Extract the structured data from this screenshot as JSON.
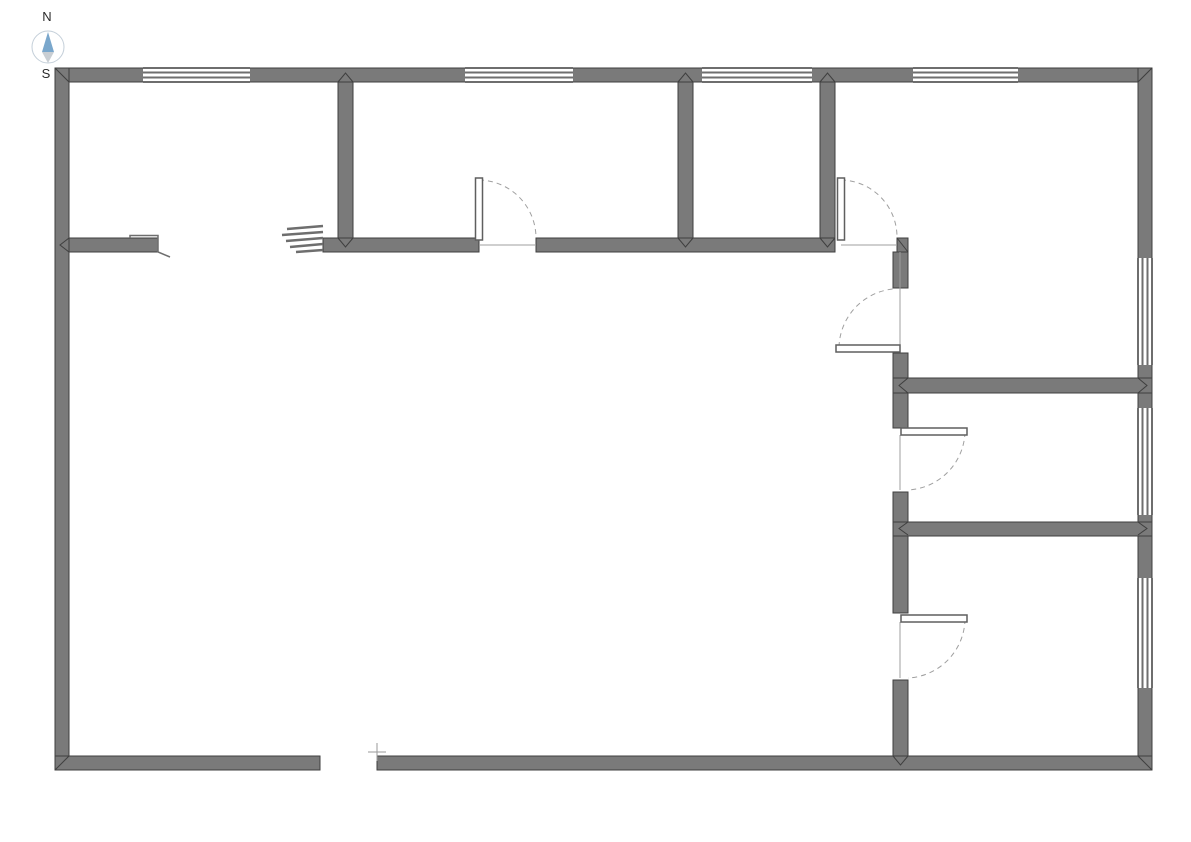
{
  "canvas": {
    "width": 1191,
    "height": 842,
    "background": "#ffffff"
  },
  "style": {
    "wall_fill": "#7a7a7a",
    "wall_stroke": "#3f3f3f",
    "window_line_color": "#6e6e6e",
    "door_line_color": "#9f9f9f"
  },
  "compass": {
    "north_label": "N",
    "south_label": "S",
    "cx": 48,
    "cy": 47,
    "radius": 16,
    "north_needle_color": "#7aa7cc",
    "south_needle_color": "#c9ced3",
    "north_points": "48,32 42,52 54,52",
    "south_points": "42,52 54,52 48,63",
    "north_label_x": 47,
    "north_label_y": 21,
    "south_label_x": 46,
    "south_label_y": 78
  },
  "floor_plan": {
    "walls": [
      {
        "name": "exterior-wall-top",
        "x": 55,
        "y": 68,
        "w": 1097,
        "h": 14
      },
      {
        "name": "exterior-wall-left",
        "x": 55,
        "y": 68,
        "w": 14,
        "h": 702
      },
      {
        "name": "exterior-wall-right",
        "x": 1138,
        "y": 68,
        "w": 14,
        "h": 702
      },
      {
        "name": "exterior-wall-bottom-west",
        "x": 55,
        "y": 756,
        "w": 265,
        "h": 14
      },
      {
        "name": "exterior-wall-bottom-east",
        "x": 377,
        "y": 756,
        "w": 775,
        "h": 14
      },
      {
        "name": "interior-wall-a",
        "x": 338,
        "y": 82,
        "w": 15,
        "h": 156
      },
      {
        "name": "interior-wall-b",
        "x": 678,
        "y": 82,
        "w": 15,
        "h": 156
      },
      {
        "name": "interior-wall-c",
        "x": 820,
        "y": 82,
        "w": 15,
        "h": 156
      },
      {
        "name": "corridor-wall-stub",
        "x": 69,
        "y": 238,
        "w": 89,
        "h": 14
      },
      {
        "name": "corridor-wall-west",
        "x": 323,
        "y": 238,
        "w": 156,
        "h": 14
      },
      {
        "name": "corridor-wall-mid",
        "x": 536,
        "y": 238,
        "w": 299,
        "h": 14
      },
      {
        "name": "corridor-wall-east",
        "x": 897,
        "y": 238,
        "w": 11,
        "h": 14
      },
      {
        "name": "right-wing-wall-seg1",
        "x": 893,
        "y": 252,
        "w": 15,
        "h": 36
      },
      {
        "name": "right-wing-wall-seg2",
        "x": 893,
        "y": 353,
        "w": 15,
        "h": 25
      },
      {
        "name": "right-wing-wall-seg3",
        "x": 893,
        "y": 393,
        "w": 15,
        "h": 35
      },
      {
        "name": "right-wing-wall-seg4",
        "x": 893,
        "y": 492,
        "w": 15,
        "h": 30
      },
      {
        "name": "right-wing-wall-seg5",
        "x": 893,
        "y": 535,
        "w": 15,
        "h": 78
      },
      {
        "name": "right-wing-wall-seg6",
        "x": 893,
        "y": 680,
        "w": 15,
        "h": 76
      },
      {
        "name": "room-divider-north",
        "x": 893,
        "y": 378,
        "w": 259,
        "h": 15
      },
      {
        "name": "room-divider-south",
        "x": 893,
        "y": 522,
        "w": 259,
        "h": 14
      }
    ],
    "windows": [
      {
        "name": "window-top-1",
        "x": 143,
        "y": 67,
        "w": 107,
        "h": 16,
        "o": "h"
      },
      {
        "name": "window-top-2",
        "x": 465,
        "y": 67,
        "w": 108,
        "h": 16,
        "o": "h"
      },
      {
        "name": "window-top-3",
        "x": 702,
        "y": 67,
        "w": 110,
        "h": 16,
        "o": "h"
      },
      {
        "name": "window-top-4",
        "x": 913,
        "y": 67,
        "w": 105,
        "h": 16,
        "o": "h"
      },
      {
        "name": "window-right-1",
        "x": 1137,
        "y": 258,
        "w": 16,
        "h": 107,
        "o": "v"
      },
      {
        "name": "window-right-2",
        "x": 1137,
        "y": 408,
        "w": 16,
        "h": 107,
        "o": "v"
      },
      {
        "name": "window-right-3",
        "x": 1137,
        "y": 578,
        "w": 16,
        "h": 110,
        "o": "v"
      }
    ],
    "doors": [
      {
        "name": "door-1",
        "leaf": {
          "x": 475.5,
          "y": 178,
          "w": 7,
          "h": 62
        },
        "arc": "M 479 180 A 58 58 0 0 1 536 238",
        "threshold": {
          "x1": 479,
          "y1": 245,
          "x2": 536,
          "y2": 245
        }
      },
      {
        "name": "door-2",
        "leaf": {
          "x": 837.5,
          "y": 178,
          "w": 7,
          "h": 62
        },
        "arc": "M 841 180 A 57 57 0 0 1 897 237",
        "threshold": {
          "x1": 841,
          "y1": 245,
          "x2": 897,
          "y2": 245
        }
      },
      {
        "name": "door-3",
        "leaf": {
          "x": 836,
          "y": 345,
          "w": 64,
          "h": 7
        },
        "arc": "M 839 347 A 60 60 0 0 1 893 289",
        "threshold": {
          "x1": 900,
          "y1": 252,
          "x2": 900,
          "y2": 345
        }
      },
      {
        "name": "door-4",
        "leaf": {
          "x": 901,
          "y": 428,
          "w": 66,
          "h": 7
        },
        "arc": "M 965 432 A 60 60 0 0 1 908 490",
        "threshold": {
          "x1": 900,
          "y1": 435,
          "x2": 900,
          "y2": 490
        }
      },
      {
        "name": "door-5",
        "leaf": {
          "x": 901,
          "y": 615,
          "w": 66,
          "h": 7
        },
        "arc": "M 965 619 A 60 60 0 0 1 908 678",
        "threshold": {
          "x1": 900,
          "y1": 622,
          "x2": 900,
          "y2": 678
        }
      }
    ],
    "joints": [
      {
        "name": "miter-top-left",
        "points": "55,68 69,82"
      },
      {
        "name": "miter-top-right",
        "points": "1152,68 1138,82"
      },
      {
        "name": "miter-bottom-left",
        "points": "55,770 69,756"
      },
      {
        "name": "miter-bottom-right",
        "points": "1152,770 1138,756"
      },
      {
        "name": "chevron-wall-a-top",
        "points": "338,82 345.5,73 353,82"
      },
      {
        "name": "chevron-wall-b-top",
        "points": "678,82 685.5,73 693,82"
      },
      {
        "name": "chevron-wall-c-top",
        "points": "820,82 827.5,73 835,82"
      },
      {
        "name": "chevron-wall-a-bot",
        "points": "338,238 345.5,247 353,238"
      },
      {
        "name": "chevron-wall-b-bot",
        "points": "678,238 685.5,247 693,238"
      },
      {
        "name": "chevron-wall-c-bot",
        "points": "820,238 827.5,247 835,238"
      },
      {
        "name": "chevron-stub-left",
        "points": "69,238 60,245 69,252"
      },
      {
        "name": "miter-corridor-east",
        "points": "897,238 908,252"
      },
      {
        "name": "chevron-div-n-left",
        "points": "908,378 899,385.5 908,393"
      },
      {
        "name": "chevron-div-n-right",
        "points": "1138,378 1147,385.5 1138,393"
      },
      {
        "name": "chevron-div-s-left",
        "points": "908,522 899,528.5 908,535"
      },
      {
        "name": "chevron-div-s-right",
        "points": "1138,522 1147,528.5 1138,535"
      },
      {
        "name": "chevron-bottom-tee",
        "points": "893,756 900.5,765 908,756"
      }
    ],
    "break_marks": [
      {
        "x1": 287,
        "y1": 229,
        "x2": 323,
        "y2": 226
      },
      {
        "x1": 282,
        "y1": 235,
        "x2": 323,
        "y2": 232
      },
      {
        "x1": 286,
        "y1": 241,
        "x2": 323,
        "y2": 238
      },
      {
        "x1": 290,
        "y1": 247,
        "x2": 323,
        "y2": 244
      },
      {
        "x1": 296,
        "y1": 252,
        "x2": 323,
        "y2": 250
      }
    ],
    "stub_break": {
      "points": "130,238 130,235.5 158,235.5 158,252 170,257"
    },
    "cross_marker": {
      "h": {
        "x1": 368,
        "y1": 752,
        "x2": 386,
        "y2": 752
      },
      "v": {
        "x1": 377,
        "y1": 743,
        "x2": 377,
        "y2": 761
      }
    }
  }
}
